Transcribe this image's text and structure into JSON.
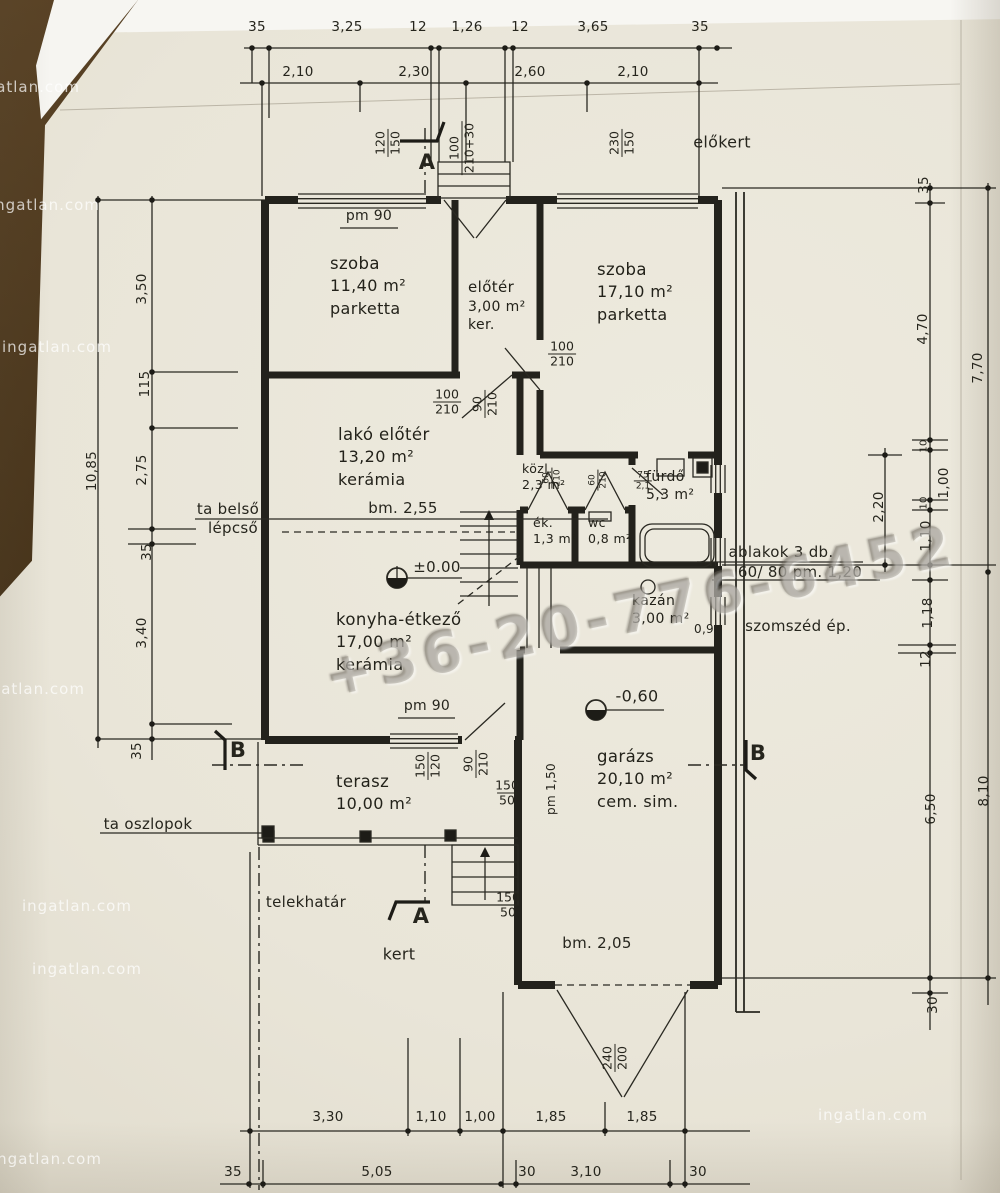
{
  "watermarks": {
    "phone": "+36-20-776-6452",
    "site": "ingatlan.com"
  },
  "sections": {
    "a": "A",
    "b": "B"
  },
  "site_labels": {
    "elokert": "előkert",
    "kert": "kert",
    "telekhatar": "telekhatár",
    "ta_oszlopok": "ta oszlopok",
    "ta_belso_1": "ta belső",
    "ta_belso_2": "lépcső",
    "szomszed": "szomszéd ép.",
    "ablakok_1": "ablakok  3 db.",
    "ablakok_2": "60/ 80 pm. 1,20"
  },
  "levels": {
    "zero": "±0.00",
    "minus060": "-0,60",
    "bm255": "bm.  2,55",
    "bm205": "bm.  2,05",
    "kazan09": "0,9"
  },
  "rooms": {
    "szoba1": {
      "name": "szoba",
      "area": "11,40 m²",
      "floor": "parketta"
    },
    "eloter": {
      "name": "előtér",
      "area": "3,00 m²",
      "floor": "ker."
    },
    "szoba2": {
      "name": "szoba",
      "area": "17,10 m²",
      "floor": "parketta"
    },
    "lako": {
      "name": "lakó előtér",
      "area": "13,20 m²",
      "floor": "kerámia"
    },
    "kozl": {
      "name": "közl.",
      "area": "2,3 m²"
    },
    "ek": {
      "name": "ék.",
      "area": "1,3 m²"
    },
    "wc": {
      "name": "wc",
      "area": "0,8 m²"
    },
    "furdo": {
      "name": "fürdő",
      "area": "5,3 m²"
    },
    "kazan": {
      "name": "kazán",
      "area": "3,00 m²"
    },
    "konyha": {
      "name": "konyha-étkező",
      "area": "17,00 m²",
      "floor": "kerámia"
    },
    "terasz": {
      "name": "terasz",
      "area": "10,00 m²"
    },
    "garazs": {
      "name": "garázs",
      "area": "20,10 m²",
      "floor": "cem. sim."
    }
  },
  "openings": {
    "pm90_top": "pm  90",
    "pm90_konyha": "pm  90",
    "pm150": "pm 1,50",
    "o120_150": {
      "top": "120",
      "bottom": "150"
    },
    "o100_210_30": {
      "top": "100",
      "bottom": "210+30"
    },
    "o230_150": {
      "top": "230",
      "bottom": "150"
    },
    "o100_210_a": {
      "top": "100",
      "bottom": "210"
    },
    "o100_210_b": {
      "top": "100",
      "bottom": "210"
    },
    "o90_210_a": {
      "top": "90",
      "bottom": "210"
    },
    "o90_210_b": {
      "top": "90",
      "bottom": "210"
    },
    "o150_120": {
      "top": "150",
      "bottom": "120"
    },
    "o150_50_a": {
      "top": "150",
      "bottom": "50"
    },
    "o150_50_b": {
      "top": "150",
      "bottom": "50"
    },
    "o240_200": {
      "top": "240",
      "bottom": "200"
    },
    "o75_21": {
      "top": "75",
      "bottom": "2,1"
    },
    "o60_a": {
      "top": "60",
      "bottom": "210"
    },
    "o60_b": {
      "top": "60",
      "bottom": "210"
    }
  },
  "dims": {
    "top1": [
      "35",
      "3,25",
      "12",
      "1,26",
      "12",
      "3,65",
      "35"
    ],
    "top2": [
      "2,10",
      "2,30",
      "2,60",
      "2,10"
    ],
    "left": [
      "3,50",
      "115",
      "2,75",
      "35",
      "3,40",
      "35"
    ],
    "left_total": "10,85",
    "right": [
      "35",
      "4,70",
      "1,00",
      "2,20",
      "1,10",
      "1,18",
      "12",
      "6,50",
      "30"
    ],
    "right_small": [
      "10",
      "10"
    ],
    "right_totals": [
      "7,70",
      "8,10"
    ],
    "bottom1": [
      "3,30",
      "1,10",
      "1,00",
      "1,85",
      "1,85"
    ],
    "bottom2": [
      "35",
      "5,05",
      "30",
      "3,10",
      "30"
    ]
  }
}
